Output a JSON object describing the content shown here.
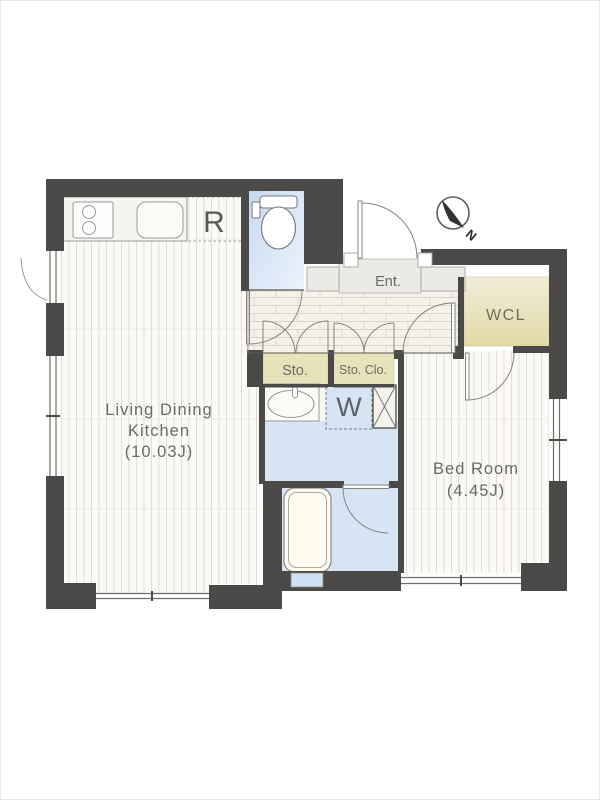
{
  "plan": {
    "labels": {
      "ldk_line1": "Living Dining",
      "ldk_line2": "Kitchen",
      "ldk_size": "(10.03J)",
      "bedroom": "Bed Room",
      "bedroom_size": "(4.45J)",
      "entrance": "Ent.",
      "wcl": "WCL",
      "storage": "Sto.",
      "storage_closet": "Sto. Clo.",
      "washer": "W",
      "refrigerator": "R",
      "compass_north": "N"
    },
    "colors": {
      "wall": "#4b4a48",
      "water_area": "#d6e4f4",
      "water_area_deep": "#c9dcf3",
      "closet_beige": "#e8e2bb",
      "floor_base": "#fbfaf5",
      "floor_line": "#ddd9cf",
      "entrance_tile": "#eceae4",
      "hall_tile": "#f4f2ea",
      "outline": "#777777",
      "label_text": "#6b6a63"
    }
  }
}
